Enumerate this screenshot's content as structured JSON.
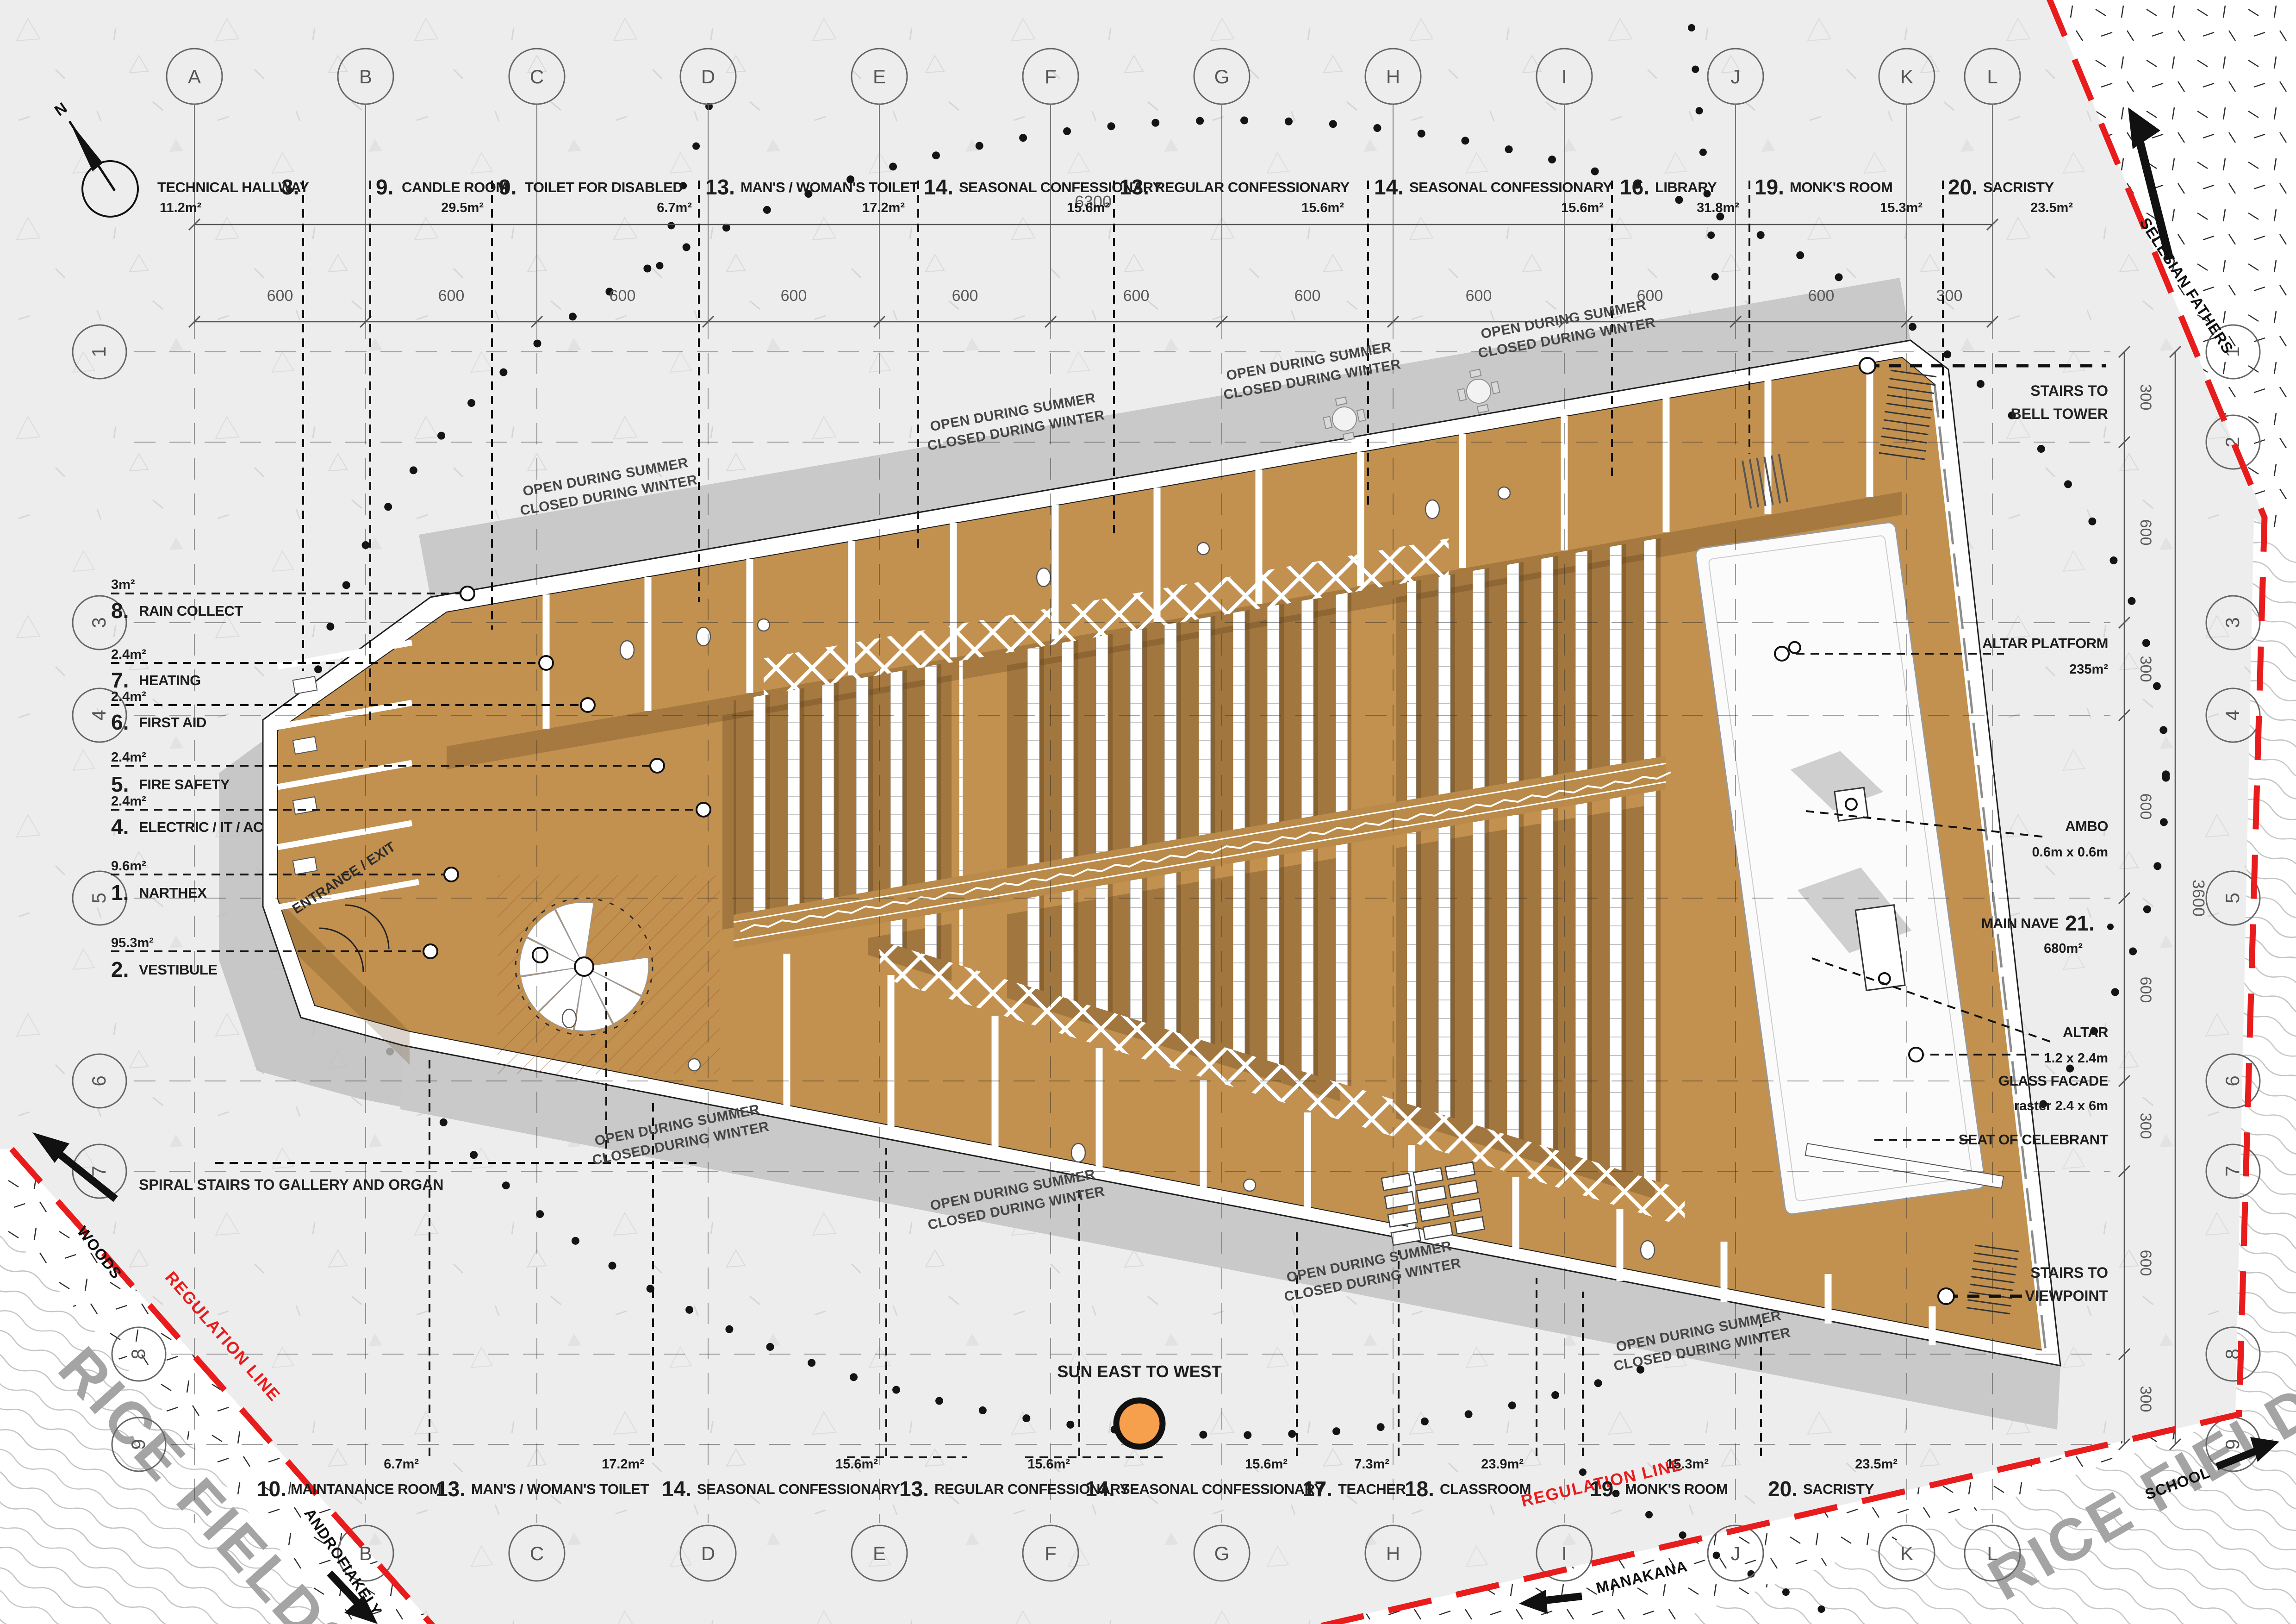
{
  "compass": {
    "north": "N"
  },
  "dims": {
    "top_total": "6300",
    "top_segments": [
      "600",
      "600",
      "600",
      "600",
      "600",
      "600",
      "600",
      "600",
      "600",
      "600",
      "300"
    ],
    "right_total": "3600",
    "right_segments": [
      "300",
      "600",
      "300",
      "600",
      "600",
      "300",
      "600",
      "300"
    ]
  },
  "grid": {
    "cols": [
      "A",
      "B",
      "C",
      "D",
      "E",
      "F",
      "G",
      "H",
      "I",
      "J",
      "K",
      "L"
    ],
    "rows": [
      "1",
      "2",
      "3",
      "4",
      "5",
      "6",
      "7",
      "8",
      "9"
    ]
  },
  "rooms_top": [
    {
      "num": "3.",
      "name": "TECHNICAL HALLWAY",
      "area": "11.2m²"
    },
    {
      "num": "9.",
      "name": "CANDLE ROOM",
      "area": "29.5m²"
    },
    {
      "num": "9.",
      "name": "TOILET FOR DISABLED",
      "area": "6.7m²"
    },
    {
      "num": "13.",
      "name": "MAN'S / WOMAN'S TOILET",
      "area": "17.2m²"
    },
    {
      "num": "14.",
      "name": "SEASONAL CONFESSIONARY",
      "area": "15.6m²"
    },
    {
      "num": "13.",
      "name": "REGULAR CONFESSIONARY",
      "area": "15.6m²"
    },
    {
      "num": "14.",
      "name": "SEASONAL CONFESSIONARY",
      "area": "15.6m²"
    },
    {
      "num": "16.",
      "name": "LIBRARY",
      "area": "31.8m²"
    },
    {
      "num": "19.",
      "name": "MONK'S ROOM",
      "area": "15.3m²"
    },
    {
      "num": "20.",
      "name": "SACRISTY",
      "area": "23.5m²"
    }
  ],
  "rooms_bottom": [
    {
      "num": "10.",
      "name": "MAINTANANCE ROOM",
      "area": "6.7m²"
    },
    {
      "num": "13.",
      "name": "MAN'S / WOMAN'S TOILET",
      "area": "17.2m²"
    },
    {
      "num": "14.",
      "name": "SEASONAL CONFESSIONARY",
      "area": "15.6m²"
    },
    {
      "num": "13.",
      "name": "REGULAR CONFESSIONARY",
      "area": "15.6m²"
    },
    {
      "num": "14.",
      "name": "SEASONAL CONFESSIONARY",
      "area": "15.6m²"
    },
    {
      "num": "17.",
      "name": "TEACHER",
      "area": "7.3m²"
    },
    {
      "num": "18.",
      "name": "CLASSROOM",
      "area": "23.9m²"
    },
    {
      "num": "19.",
      "name": "MONK'S ROOM",
      "area": "15.3m²"
    },
    {
      "num": "20.",
      "name": "SACRISTY",
      "area": "23.5m²"
    }
  ],
  "rooms_left": [
    {
      "num": "8.",
      "name": "RAIN COLLECT",
      "area": "3m²"
    },
    {
      "num": "7.",
      "name": "HEATING",
      "area": "2.4m²"
    },
    {
      "num": "6.",
      "name": "FIRST AID",
      "area": "2.4m²"
    },
    {
      "num": "5.",
      "name": "FIRE SAFETY",
      "area": "2.4m²"
    },
    {
      "num": "4.",
      "name": "ELECTRIC / IT / AC",
      "area": "2.4m²"
    },
    {
      "num": "1.",
      "name": "NARTHEX",
      "area": "9.6m²"
    },
    {
      "num": "2.",
      "name": "VESTIBULE",
      "area": "95.3m²"
    }
  ],
  "labels_right": {
    "bell_1": "STAIRS TO",
    "bell_2": "BELL TOWER",
    "altar_platform": {
      "name": "ALTAR PLATFORM",
      "area": "235m²"
    },
    "ambo": {
      "name": "AMBO",
      "size": "0.6m x 0.6m"
    },
    "altar": {
      "name": "ALTAR",
      "size": "1.2 x 2.4m"
    },
    "nave": {
      "name": "MAIN NAVE",
      "num": "21.",
      "area": "680m²"
    },
    "facade": {
      "name": "GLASS FACADE",
      "size": "raster 2.4 x 6m"
    },
    "seat": "SEAT OF CELEBRANT",
    "view_1": "STAIRS TO",
    "view_2": "VIEWPOINT"
  },
  "notes": {
    "entrance": "ENTRANCE / EXIT",
    "spiral": "SPIRAL STAIRS TO GALLERY AND ORGAN",
    "sun": "SUN EAST TO WEST",
    "open": "OPEN DURING SUMMER",
    "closed": "CLOSED DURING WINTER",
    "regulation": "REGULATION LINE"
  },
  "context": {
    "rice": "RICE FIELDS",
    "woods": "WOODS",
    "school": "SCHOOL",
    "selesian": "SELESIAN FATHERS",
    "androfiakely": "ANDROFIAKELY",
    "manakana": "MANAKANA"
  },
  "colors": {
    "floor": "#c2914f",
    "floor_dark": "#a67e3f",
    "wall": "#ffffff",
    "canopy": "#c9c9c9",
    "shadow": "#bdbdbd",
    "regulation": "#e81c1c",
    "sun": "#f6a04d",
    "background": "#ededed"
  }
}
